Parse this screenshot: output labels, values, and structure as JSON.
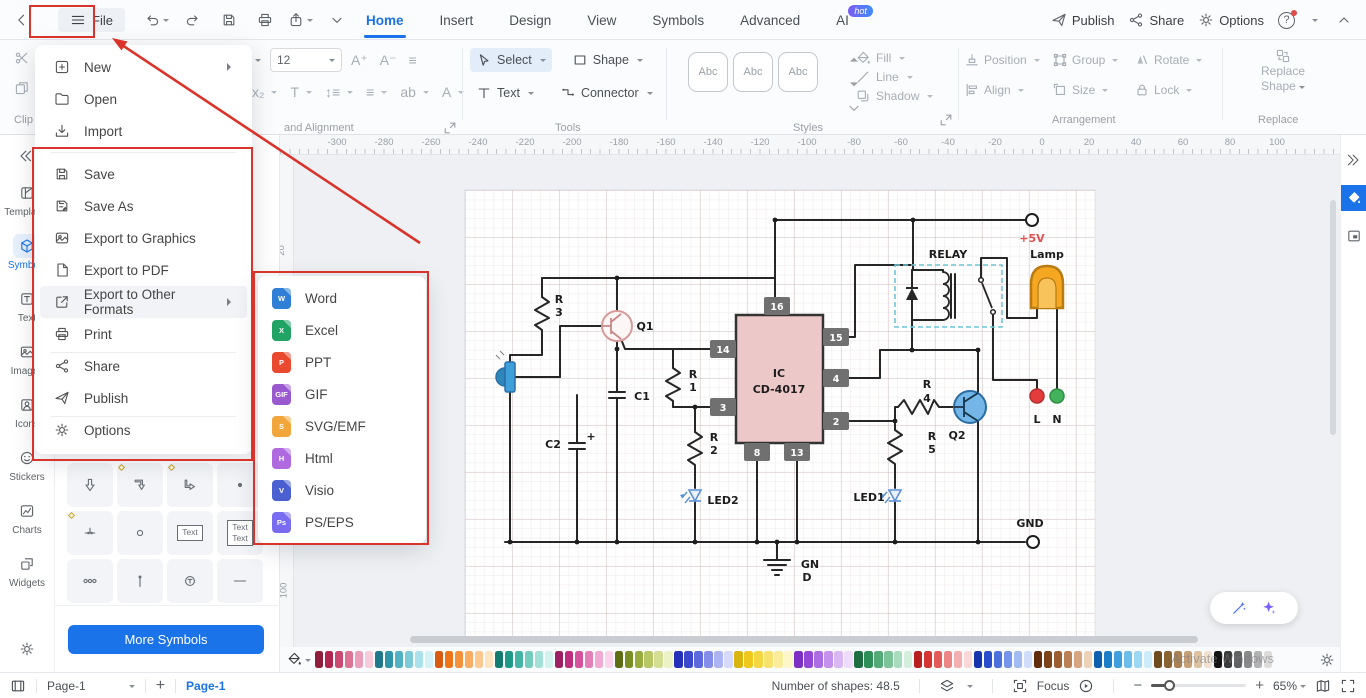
{
  "titlebar": {
    "file_button": {
      "label": "File"
    },
    "quick_actions": [
      {
        "icon": "undo",
        "caret": true
      },
      {
        "icon": "redo"
      },
      {
        "icon": "floppy"
      },
      {
        "icon": "printer"
      },
      {
        "icon": "export",
        "caret": true
      },
      {
        "icon": "chevron-down"
      }
    ],
    "tabs": [
      {
        "label": "Home",
        "active": true
      },
      {
        "label": "Insert"
      },
      {
        "label": "Design"
      },
      {
        "label": "View"
      },
      {
        "label": "Symbols"
      },
      {
        "label": "Advanced"
      },
      {
        "label": "AI",
        "badge": "hot"
      }
    ],
    "right_actions": [
      {
        "icon": "plane",
        "label": "Publish"
      },
      {
        "icon": "share-nodes",
        "label": "Share"
      },
      {
        "icon": "gear",
        "label": "Options"
      }
    ],
    "help_label": "?"
  },
  "ribbon": {
    "clipboard_label": "Clip",
    "font_size": "12",
    "font_row1": [
      "A⁺",
      "A⁻",
      "≡"
    ],
    "font_row2": [
      "x₂",
      "T",
      "↕≡",
      "≡",
      "ab",
      "A"
    ],
    "font_group_label": "and Alignment",
    "tools": {
      "select": "Select",
      "sh": "Shape",
      "tx": "Text",
      "conn": "Connector",
      "group_label": "Tools"
    },
    "styles": {
      "samples": [
        "Abc",
        "Abc",
        "Abc"
      ],
      "group_label": "Styles"
    },
    "style_tools": [
      {
        "icon": "fill-drop",
        "label": "Fill"
      },
      {
        "icon": "line-icon",
        "label": "Line"
      },
      {
        "icon": "shadow-icon",
        "label": "Shadow"
      }
    ],
    "arrangement": {
      "buttons": [
        {
          "icon": "position-icon",
          "label": "Position"
        },
        {
          "icon": "group-icon",
          "label": "Group"
        },
        {
          "icon": "rotate-icon",
          "label": "Rotate"
        },
        {
          "icon": "align-icon",
          "label": "Align"
        },
        {
          "icon": "size-icon",
          "label": "Size"
        },
        {
          "icon": "lock-icon",
          "label": "Lock"
        }
      ],
      "group_label": "Arrangement"
    },
    "replace": {
      "line1": "Replace",
      "line2": "Shape",
      "group_label": "Replace"
    }
  },
  "file_menu": {
    "items_top": [
      {
        "label": "New",
        "icon": "plus-square",
        "submenu": true
      },
      {
        "label": "Open",
        "icon": "folder"
      },
      {
        "label": "Import",
        "icon": "import"
      }
    ],
    "items_main": [
      {
        "label": "Save",
        "icon": "floppy"
      },
      {
        "label": "Save As",
        "icon": "floppy-as"
      },
      {
        "label": "Export to Graphics",
        "icon": "image"
      },
      {
        "label": "Export to PDF",
        "icon": "pdf"
      },
      {
        "label": "Export to Other Formats",
        "icon": "external",
        "submenu": true,
        "highlighted": true
      },
      {
        "label": "Print",
        "icon": "printer",
        "divider_after": true
      },
      {
        "label": "Share",
        "icon": "share-nodes"
      },
      {
        "label": "Publish",
        "icon": "plane",
        "divider_after": true
      },
      {
        "label": "Options",
        "icon": "gear"
      }
    ]
  },
  "export_submenu": [
    {
      "label": "Word",
      "letter": "W",
      "color": "#2f7fd6"
    },
    {
      "label": "Excel",
      "letter": "X",
      "color": "#21a366"
    },
    {
      "label": "PPT",
      "letter": "P",
      "color": "#e8492f"
    },
    {
      "label": "GIF",
      "letter": "GIF",
      "color": "#9b59d0"
    },
    {
      "label": "SVG/EMF",
      "letter": "S",
      "color": "#f0a63a"
    },
    {
      "label": "Html",
      "letter": "H",
      "color": "#b06ae0"
    },
    {
      "label": "Visio",
      "letter": "V",
      "color": "#4a5fd0"
    },
    {
      "label": "PS/EPS",
      "letter": "Ps",
      "color": "#7a6cf0"
    }
  ],
  "sidebar": {
    "items": [
      {
        "label": "Templates",
        "icon": "template"
      },
      {
        "label": "Symbols",
        "icon": "symbols",
        "active": true
      },
      {
        "label": "Text",
        "icon": "text-t"
      },
      {
        "label": "Images",
        "icon": "image"
      },
      {
        "label": "Icons",
        "icon": "icons-badge"
      },
      {
        "label": "Stickers",
        "icon": "sticker"
      },
      {
        "label": "Charts",
        "icon": "chart"
      },
      {
        "label": "Widgets",
        "icon": "widget"
      }
    ]
  },
  "symbols_panel": {
    "tiles": [
      {
        "icon": "sym-arrow-down"
      },
      {
        "icon": "sym-corner-down",
        "handle": true
      },
      {
        "icon": "sym-corner-right",
        "handle": true
      },
      {
        "icon": "sym-dot"
      },
      {
        "icon": "sym-junction",
        "handle": true
      },
      {
        "icon": "sym-circle"
      },
      {
        "text": "Text"
      },
      {
        "text": "Text\nText"
      },
      {
        "icon": "sym-three-circles"
      },
      {
        "icon": "sym-pin"
      },
      {
        "icon": "sym-t-circle"
      },
      {
        "icon": "sym-line"
      }
    ],
    "more_button": "More Symbols"
  },
  "canvas": {
    "h_ruler": [
      "-300",
      "-280",
      "-260",
      "-240",
      "-220",
      "-200",
      "-180",
      "-160",
      "-140",
      "-120",
      "-100",
      "-80",
      "-60",
      "-40",
      "-20",
      "0",
      "20",
      "40",
      "60",
      "80",
      "100"
    ],
    "v_ruler": [
      "20",
      "40",
      "60",
      "80",
      "100"
    ],
    "circuit": {
      "ic": {
        "line1": "IC",
        "line2": "CD-4017"
      },
      "pins": [
        {
          "n": "16",
          "x": 299,
          "y": 107
        },
        {
          "n": "15",
          "x": 358,
          "y": 138
        },
        {
          "n": "4",
          "x": 358,
          "y": 179
        },
        {
          "n": "2",
          "x": 358,
          "y": 222
        },
        {
          "n": "14",
          "x": 245,
          "y": 150
        },
        {
          "n": "3",
          "x": 245,
          "y": 208
        },
        {
          "n": "8",
          "x": 279,
          "y": 253
        },
        {
          "n": "13",
          "x": 319,
          "y": 253
        }
      ],
      "labels": [
        {
          "t": "+5V",
          "x": 567,
          "y": 52,
          "color": "#e05252"
        },
        {
          "t": "RELAY",
          "x": 483,
          "y": 68
        },
        {
          "t": "Lamp",
          "x": 582,
          "y": 68
        },
        {
          "t": "R",
          "x": 94,
          "y": 113
        },
        {
          "t": "3",
          "x": 94,
          "y": 126
        },
        {
          "t": "Q1",
          "x": 180,
          "y": 140
        },
        {
          "t": "C1",
          "x": 177,
          "y": 210
        },
        {
          "t": "R",
          "x": 228,
          "y": 188
        },
        {
          "t": "1",
          "x": 228,
          "y": 201
        },
        {
          "t": "C2",
          "x": 88,
          "y": 258
        },
        {
          "t": "+",
          "x": 126,
          "y": 250
        },
        {
          "t": "R",
          "x": 249,
          "y": 251
        },
        {
          "t": "2",
          "x": 249,
          "y": 264
        },
        {
          "t": "LED2",
          "x": 258,
          "y": 314
        },
        {
          "t": "R",
          "x": 462,
          "y": 198
        },
        {
          "t": "4",
          "x": 462,
          "y": 212
        },
        {
          "t": "Q2",
          "x": 492,
          "y": 249
        },
        {
          "t": "R",
          "x": 467,
          "y": 250
        },
        {
          "t": "5",
          "x": 467,
          "y": 263
        },
        {
          "t": "LED1",
          "x": 404,
          "y": 311
        },
        {
          "t": "L",
          "x": 572,
          "y": 233
        },
        {
          "t": "N",
          "x": 592,
          "y": 233
        },
        {
          "t": "GND",
          "x": 565,
          "y": 337
        },
        {
          "t": "GN",
          "x": 345,
          "y": 378
        },
        {
          "t": "D",
          "x": 342,
          "y": 391
        }
      ]
    }
  },
  "palette": {
    "swatches": [
      "#8f1d3c",
      "#b22550",
      "#cb4a72",
      "#dd7495",
      "#eb9fb8",
      "#f6cbda",
      "#20788c",
      "#2f95a8",
      "#52b1c2",
      "#7ecbd8",
      "#aae1ea",
      "#d4f2f6",
      "#d95b12",
      "#ef7417",
      "#f5913a",
      "#f9ad62",
      "#fcc98e",
      "#fee4c0",
      "#137c6e",
      "#1f9a89",
      "#44b5a4",
      "#74ccbf",
      "#a3e1d8",
      "#d2f2ed",
      "#9c2063",
      "#bd2f7e",
      "#d4539c",
      "#e57fba",
      "#f0aad4",
      "#f9d4ea",
      "#5d6e14",
      "#7a8f22",
      "#98ac3e",
      "#b7c766",
      "#d3de94",
      "#ecf1c6",
      "#2430b8",
      "#3a48cc",
      "#5c68dc",
      "#848eea",
      "#adb4f3",
      "#d6d9fa",
      "#d9b40e",
      "#eec81c",
      "#f4d643",
      "#f8e26e",
      "#fbec9b",
      "#fdf6c9",
      "#7d2fc4",
      "#9447d6",
      "#ac6ce2",
      "#c492ec",
      "#dab8f4",
      "#eedcfa",
      "#1f6e42",
      "#2f8f58",
      "#52aa76",
      "#7cc398",
      "#a8dcbd",
      "#d4eede",
      "#b81f1f",
      "#d63333",
      "#e25b5b",
      "#ec8585",
      "#f4b0b0",
      "#fad8d8",
      "#1734ad",
      "#2a4ecb",
      "#4c70dc",
      "#7695ea",
      "#a2bbf3",
      "#d0ddfa",
      "#5f2d0c",
      "#7d4318",
      "#9c5e31",
      "#bb7f55",
      "#d8a582",
      "#eed2b8",
      "#0f5fad",
      "#1b7ec7",
      "#3f9edb",
      "#6cbde9",
      "#9cd8f3",
      "#cdecfa",
      "#6e4a1f",
      "#8a6333",
      "#a98051",
      "#c6a077",
      "#ddc2a2",
      "#f0e1d0",
      "#141414",
      "#3a3a3a",
      "#616161",
      "#8a8a8a",
      "#b3b3b3",
      "#dcdcdc"
    ]
  },
  "statusbar": {
    "page_selector": "Page-1",
    "add_page": "+",
    "page_tab": "Page-1",
    "shapes_label": "Number of shapes: 48.5",
    "focus_label": "Focus",
    "zoom_value": "65%"
  },
  "watermark": "Activate Windows",
  "annotations": {
    "color": "#d9342b",
    "boxes": [
      "file-button",
      "file-menu-save-section",
      "export-submenu"
    ],
    "arrow_target": "file-button"
  }
}
